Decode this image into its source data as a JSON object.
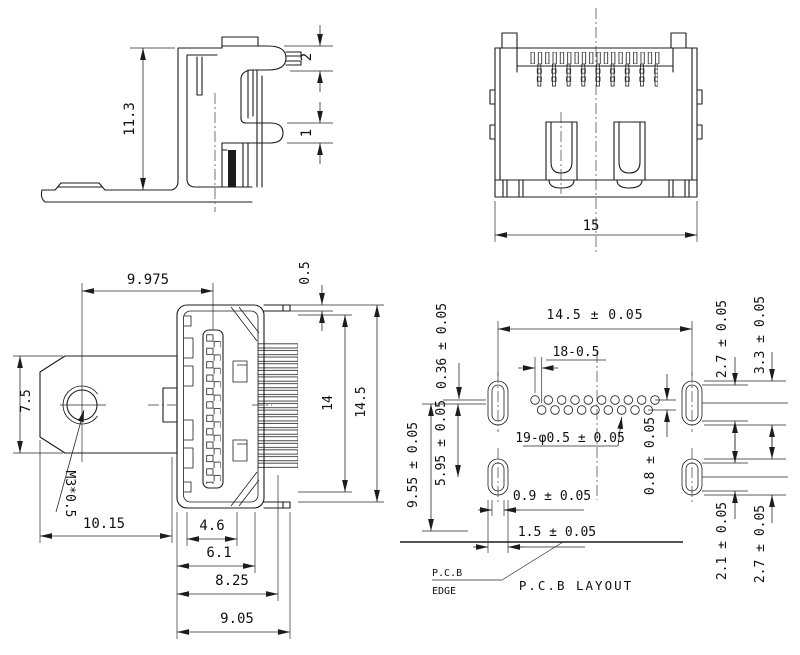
{
  "page": {
    "background": "#ffffff",
    "line_color": "#1c1c1c",
    "description": "HDMI connector technical drawing"
  },
  "side_view": {
    "height": "11.3",
    "upper_pin": "2",
    "lower_pin": "1"
  },
  "front_view": {
    "width": "15"
  },
  "top_view": {
    "hole_to_center": "9.975",
    "shell_step": "0.5",
    "flange_height": "7.5",
    "thread_callout": "M3*0.5",
    "body_height": "14",
    "overall_height": "14.5",
    "flange_length": "10.15",
    "cavity_width": "4.6",
    "tongue_width": "6.1",
    "shell_width": "8.25",
    "overall_width": "9.05"
  },
  "pcb_layout": {
    "slot_span": "14.5 ± 0.05",
    "pin_pitch": "18-0.5",
    "row_offset": "0.36 ± 0.05",
    "slot_inner_top": "2.7 ± 0.05",
    "slot_outer_top": "3.3 ± 0.05",
    "slot_row_gap": "5.95 ± 0.05",
    "edge_distance": "9.55 ± 0.05",
    "hole_callout": "19-φ0.5 ± 0.05",
    "row_stagger": "0.8 ± 0.05",
    "slot_width_inner": "0.9 ± 0.05",
    "slot_width_outer": "1.5 ± 0.05",
    "slot_inner_bottom": "2.1 ± 0.05",
    "slot_outer_bottom": "2.7 ± 0.05",
    "edge_label_line1": "P.C.B",
    "edge_label_line2": "EDGE",
    "title": "P.C.B  LAYOUT"
  }
}
